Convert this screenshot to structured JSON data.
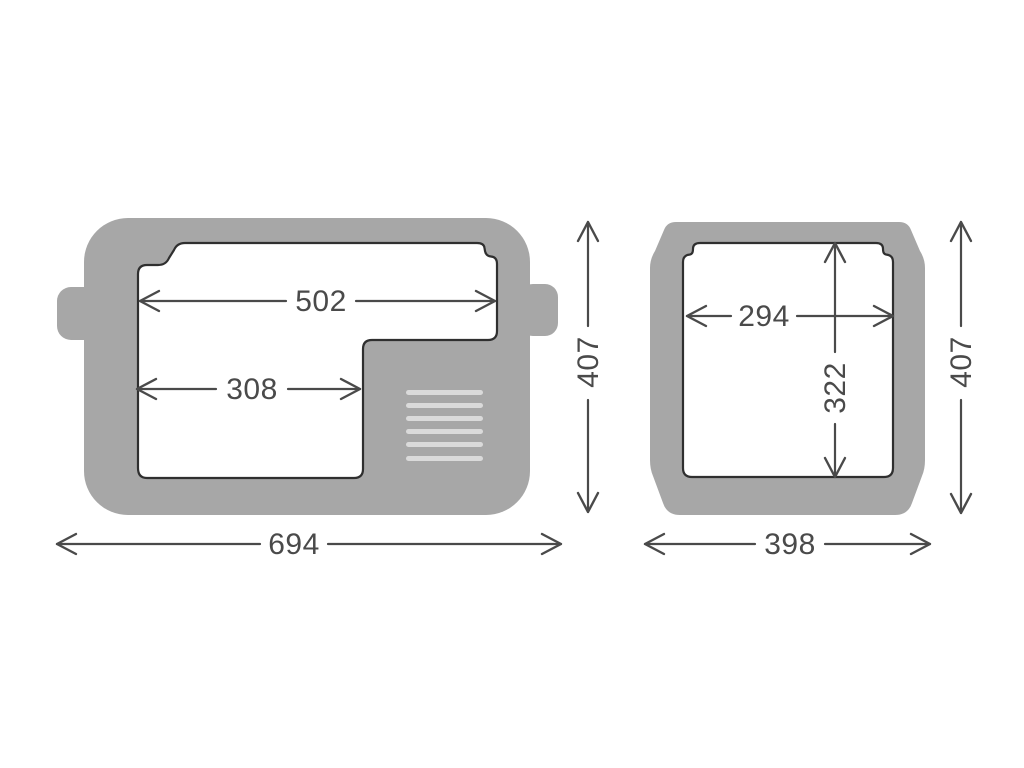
{
  "diagram": {
    "side_view": {
      "inner_top_width": "502",
      "inner_bottom_width": "308",
      "outer_width": "694",
      "outer_height": "407"
    },
    "front_view": {
      "inner_width": "294",
      "inner_height": "322",
      "outer_width": "398",
      "outer_height": "407"
    },
    "vent_slat_count": 6,
    "colors": {
      "body": "#a7a7a7",
      "interior": "#ffffff",
      "outline": "#2f2f2f",
      "dimension": "#4a4a4a",
      "vent_slat": "#dadada",
      "background": "#ffffff"
    }
  }
}
